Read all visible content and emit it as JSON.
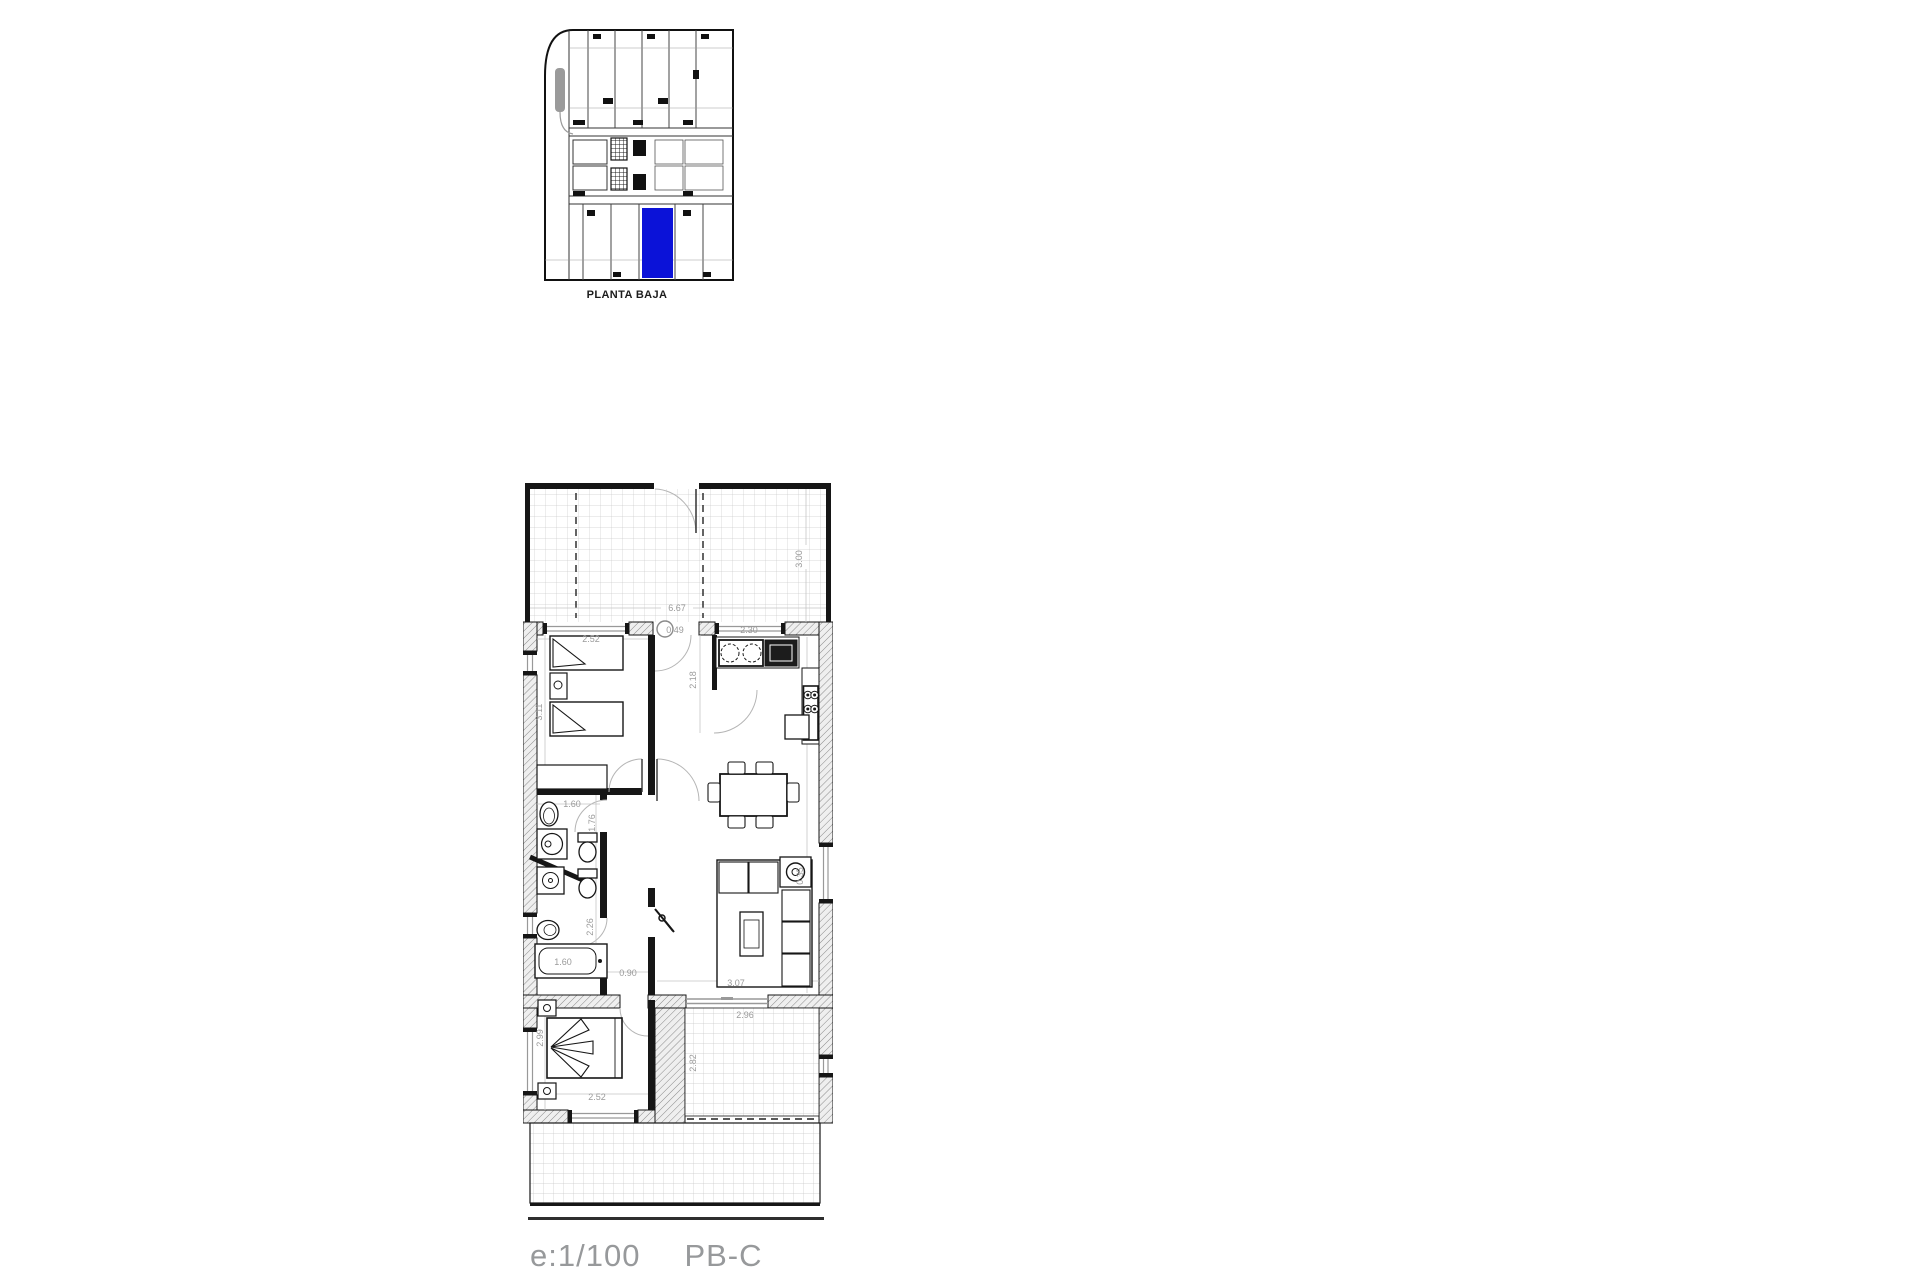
{
  "overview_plan": {
    "caption": "PLANTA BAJA",
    "highlight_color": "#0b12d8"
  },
  "main_plan": {
    "dims": {
      "terrace_width": "6.67",
      "terrace_depth": "3.00",
      "bedroom2_width": "2.52",
      "bedroom2_depth": "3.11",
      "entry_width": "0.49",
      "hall_depth": "2.18",
      "kitchen_width": "2.30",
      "bath1_width": "1.60",
      "bath1_depth": "1.76",
      "bath2_depth": "2.26",
      "bathtub_length": "1.60",
      "corridor_width": "0.90",
      "living_width": "3.07",
      "sofa_side": "0.35",
      "bedroom1_width": "2.52",
      "bedroom1_depth": "2.99",
      "patio_width": "2.96",
      "patio_depth": "2.82"
    }
  },
  "footer": {
    "scale_label": "e:1/100",
    "unit_label": "PB-C"
  },
  "colors": {
    "wall": "#161616",
    "dim_text": "#9a9a9a"
  }
}
